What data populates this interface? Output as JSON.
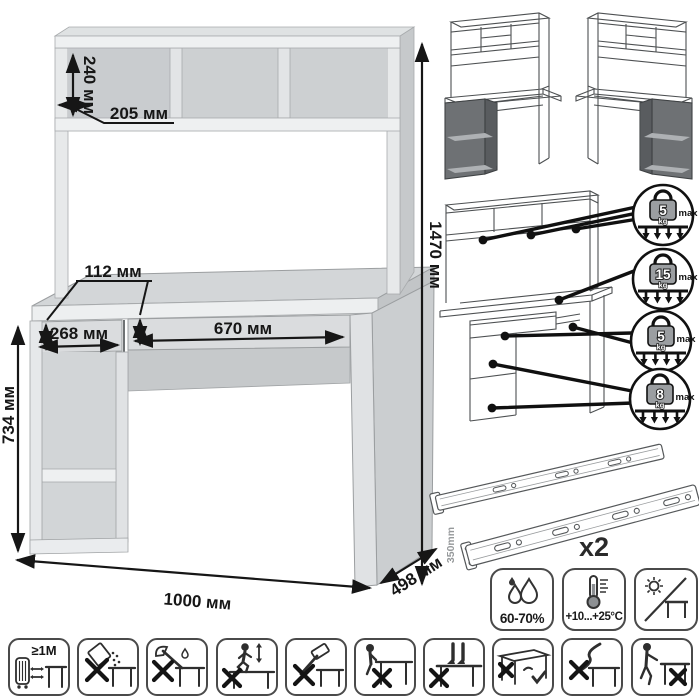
{
  "title": "desk-with-hutch-dimension-diagram",
  "colors": {
    "background": "#ffffff",
    "panel_light": "#eef0f1",
    "panel_mid": "#dadcde",
    "panel_shade": "#c6c9cb",
    "dark_accent": "#6e7174",
    "line": "#161616",
    "weight_fill": "#9b9ea1"
  },
  "dimensions": {
    "shelf_height": "240 мм",
    "shelf_depth": "205 мм",
    "total_height": "1470 мм",
    "front_height": "112 мм",
    "left_section_width": "268 мм",
    "drawer_width": "670 мм",
    "desk_height": "734 мм",
    "total_width": "1000 мм",
    "total_depth": "498 мм"
  },
  "variant_thumbnails": [
    "hutch-desk-shelves-left",
    "hutch-desk-shelves-right"
  ],
  "load_limits": [
    {
      "target": "hutch-shelves",
      "value": "5",
      "unit": "kg",
      "note": "max"
    },
    {
      "target": "desktop",
      "value": "15",
      "unit": "kg",
      "note": "max"
    },
    {
      "target": "drawer",
      "value": "5",
      "unit": "kg",
      "note": "max"
    },
    {
      "target": "side-shelves",
      "value": "8",
      "unit": "kg",
      "note": "max"
    }
  ],
  "hardware": {
    "part": "ball-bearing-drawer-slides",
    "slide_length": "350mm",
    "quantity": "x2"
  },
  "environment": {
    "humidity": "60-70%",
    "temperature": "+10...+25°C",
    "sunlight": "no-direct-sunlight"
  },
  "care": {
    "min_distance": "≥1М",
    "pictograms": [
      "keep-1m-from-heat-sources",
      "no-spilling-liquids",
      "no-chopping-with-axe",
      "no-jumping-on-top",
      "no-hammering",
      "no-sitting-on-edge",
      "no-standing-on-top",
      "lift-from-under-top",
      "no-pulling-by-cord",
      "no-dragging-across-floor"
    ]
  }
}
